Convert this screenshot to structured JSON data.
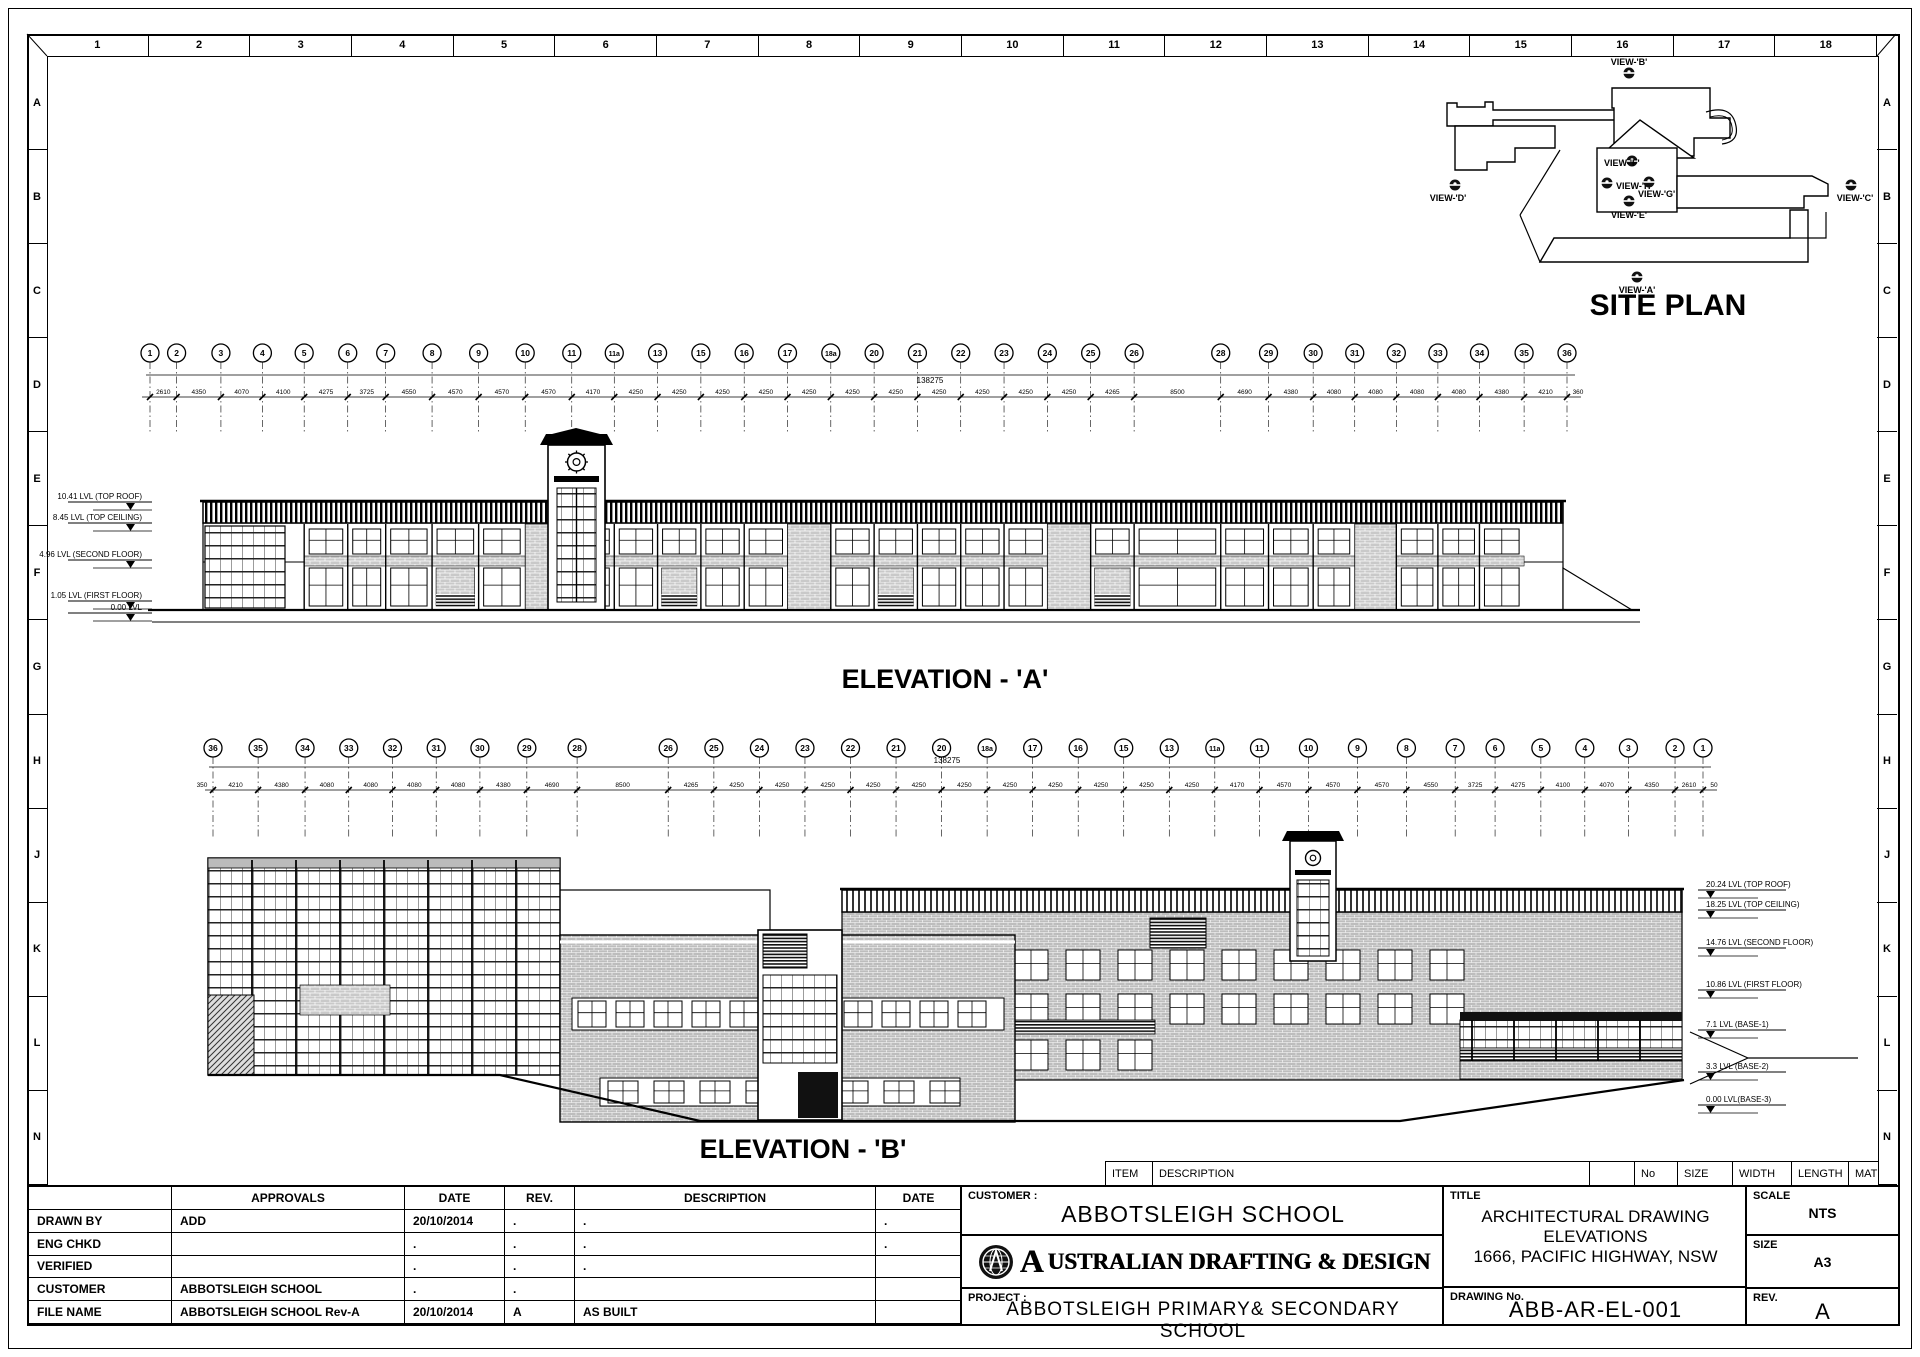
{
  "sheet": {
    "column_labels": [
      "1",
      "2",
      "3",
      "4",
      "5",
      "6",
      "7",
      "8",
      "9",
      "10",
      "11",
      "12",
      "13",
      "14",
      "15",
      "16",
      "17",
      "18"
    ],
    "row_labels": [
      "A",
      "B",
      "C",
      "D",
      "E",
      "F",
      "G",
      "H",
      "J",
      "K",
      "L",
      "N"
    ]
  },
  "site_plan": {
    "title": "SITE PLAN",
    "view_labels": [
      "VIEW-'B'",
      "VIEW-'D'",
      "VIEW-'F'",
      "VIEW-'H'",
      "VIEW-'G'",
      "VIEW-'E'",
      "VIEW-'C'",
      "VIEW-'A'"
    ]
  },
  "elevation_a": {
    "title": "ELEVATION - 'A'",
    "overall_dim": "138275",
    "grid_bubbles": [
      "1",
      "2",
      "3",
      "4",
      "5",
      "6",
      "7",
      "8",
      "9",
      "10",
      "11",
      "11a",
      "13",
      "15",
      "16",
      "17",
      "18a",
      "20",
      "21",
      "22",
      "23",
      "24",
      "25",
      "26",
      "28",
      "29",
      "30",
      "31",
      "32",
      "33",
      "34",
      "35",
      "36"
    ],
    "span_dims": [
      "2610",
      "4350",
      "4070",
      "4100",
      "4275",
      "3725",
      "4550",
      "4570",
      "4570",
      "4570",
      "4170",
      "4250",
      "4250",
      "4250",
      "4250",
      "4250",
      "4250",
      "4250",
      "4250",
      "4250",
      "4250",
      "4250",
      "4265",
      "8500",
      "4690",
      "4380",
      "4080",
      "4080",
      "4080",
      "4080",
      "4380",
      "4210"
    ],
    "trailing_dim": "360",
    "level_labels": [
      "10.41 LVL (TOP ROOF)",
      "8.45 LVL (TOP CEILING)",
      "4.96 LVL (SECOND FLOOR)",
      "1.05 LVL (FIRST FLOOR)",
      "0.00 LVL"
    ]
  },
  "elevation_b": {
    "title": "ELEVATION - 'B'",
    "overall_dim": "138275",
    "grid_bubbles": [
      "36",
      "35",
      "34",
      "33",
      "32",
      "31",
      "30",
      "29",
      "28",
      "26",
      "25",
      "24",
      "23",
      "22",
      "21",
      "20",
      "18a",
      "17",
      "16",
      "15",
      "13",
      "11a",
      "11",
      "10",
      "9",
      "8",
      "7",
      "6",
      "5",
      "4",
      "3",
      "2",
      "1"
    ],
    "span_dims": [
      "4210",
      "4380",
      "4080",
      "4080",
      "4080",
      "4080",
      "4380",
      "4690",
      "8500",
      "4265",
      "4250",
      "4250",
      "4250",
      "4250",
      "4250",
      "4250",
      "4250",
      "4250",
      "4250",
      "4250",
      "4250",
      "4170",
      "4570",
      "4570",
      "4570",
      "4550",
      "3725",
      "4275",
      "4100",
      "4070",
      "4350",
      "2610"
    ],
    "leading_dim": "350",
    "trailing_dim": "50",
    "level_labels": [
      "20.24 LVL (TOP ROOF)",
      "18.25 LVL (TOP CEILING)",
      "14.76 LVL (SECOND FLOOR)",
      "10.86 LVL (FIRST FLOOR)",
      "7.1 LVL (BASE-1)",
      "3.3 LVL (BASE-2)",
      "0.00 LVL(BASE-3)"
    ]
  },
  "item_strip": {
    "headers": [
      "ITEM",
      "DESCRIPTION",
      "",
      "No",
      "SIZE",
      "WIDTH",
      "LENGTH",
      "MATERIAL"
    ]
  },
  "approvals_table": {
    "col_headers": [
      "",
      "APPROVALS",
      "DATE",
      "REV.",
      "DESCRIPTION",
      "DATE"
    ],
    "rows": [
      [
        "DRAWN BY",
        "ADD",
        "20/10/2014",
        ".",
        ".",
        "."
      ],
      [
        "ENG CHKD",
        "",
        ".",
        ".",
        ".",
        "."
      ],
      [
        "VERIFIED",
        "",
        ".",
        ".",
        ".",
        ""
      ],
      [
        "CUSTOMER",
        "ABBOTSLEIGH SCHOOL",
        ".",
        ".",
        "",
        ""
      ],
      [
        "FILE NAME",
        "ABBOTSLEIGH SCHOOL Rev-A",
        "20/10/2014",
        "A",
        "AS BUILT",
        ""
      ]
    ]
  },
  "title_block": {
    "customer_label": "CUSTOMER :",
    "customer": "ABBOTSLEIGH SCHOOL",
    "company": "AUSTRALIAN DRAFTING & DESIGN",
    "project_label": "PROJECT :",
    "project": "ABBOTSLEIGH PRIMARY& SECONDARY SCHOOL",
    "title_label": "TITLE",
    "title_line1": "ARCHITECTURAL DRAWING",
    "title_line2": "ELEVATIONS",
    "title_line3": "1666, PACIFIC HIGHWAY, NSW",
    "drawing_no_label": "DRAWING No.",
    "drawing_no": "ABB-AR-EL-001",
    "scale_label": "SCALE",
    "scale": "NTS",
    "size_label": "SIZE",
    "size": "A3",
    "rev_label": "REV.",
    "rev": "A"
  },
  "colors": {
    "line": "#000000",
    "paper": "#ffffff",
    "brick_grey": "#c6c6c6"
  }
}
